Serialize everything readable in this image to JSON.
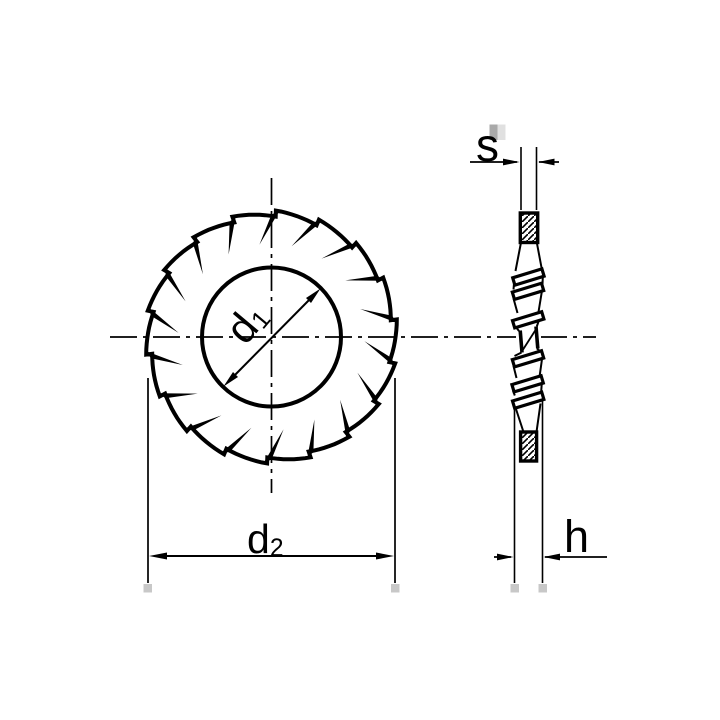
{
  "page": {
    "background": "#ffffff"
  },
  "drawing": {
    "ink_color": "#000000",
    "marker_gray": "#c8c8c8",
    "front_view": {
      "teeth_count": 18,
      "labels": {
        "inner_diameter": {
          "base": "d",
          "sub": "1"
        },
        "outer_diameter": {
          "base": "d",
          "sub": "2"
        }
      }
    },
    "side_view": {
      "labels": {
        "thickness": {
          "base": "s",
          "sub": ""
        },
        "height": {
          "base": "h",
          "sub": ""
        }
      }
    }
  }
}
